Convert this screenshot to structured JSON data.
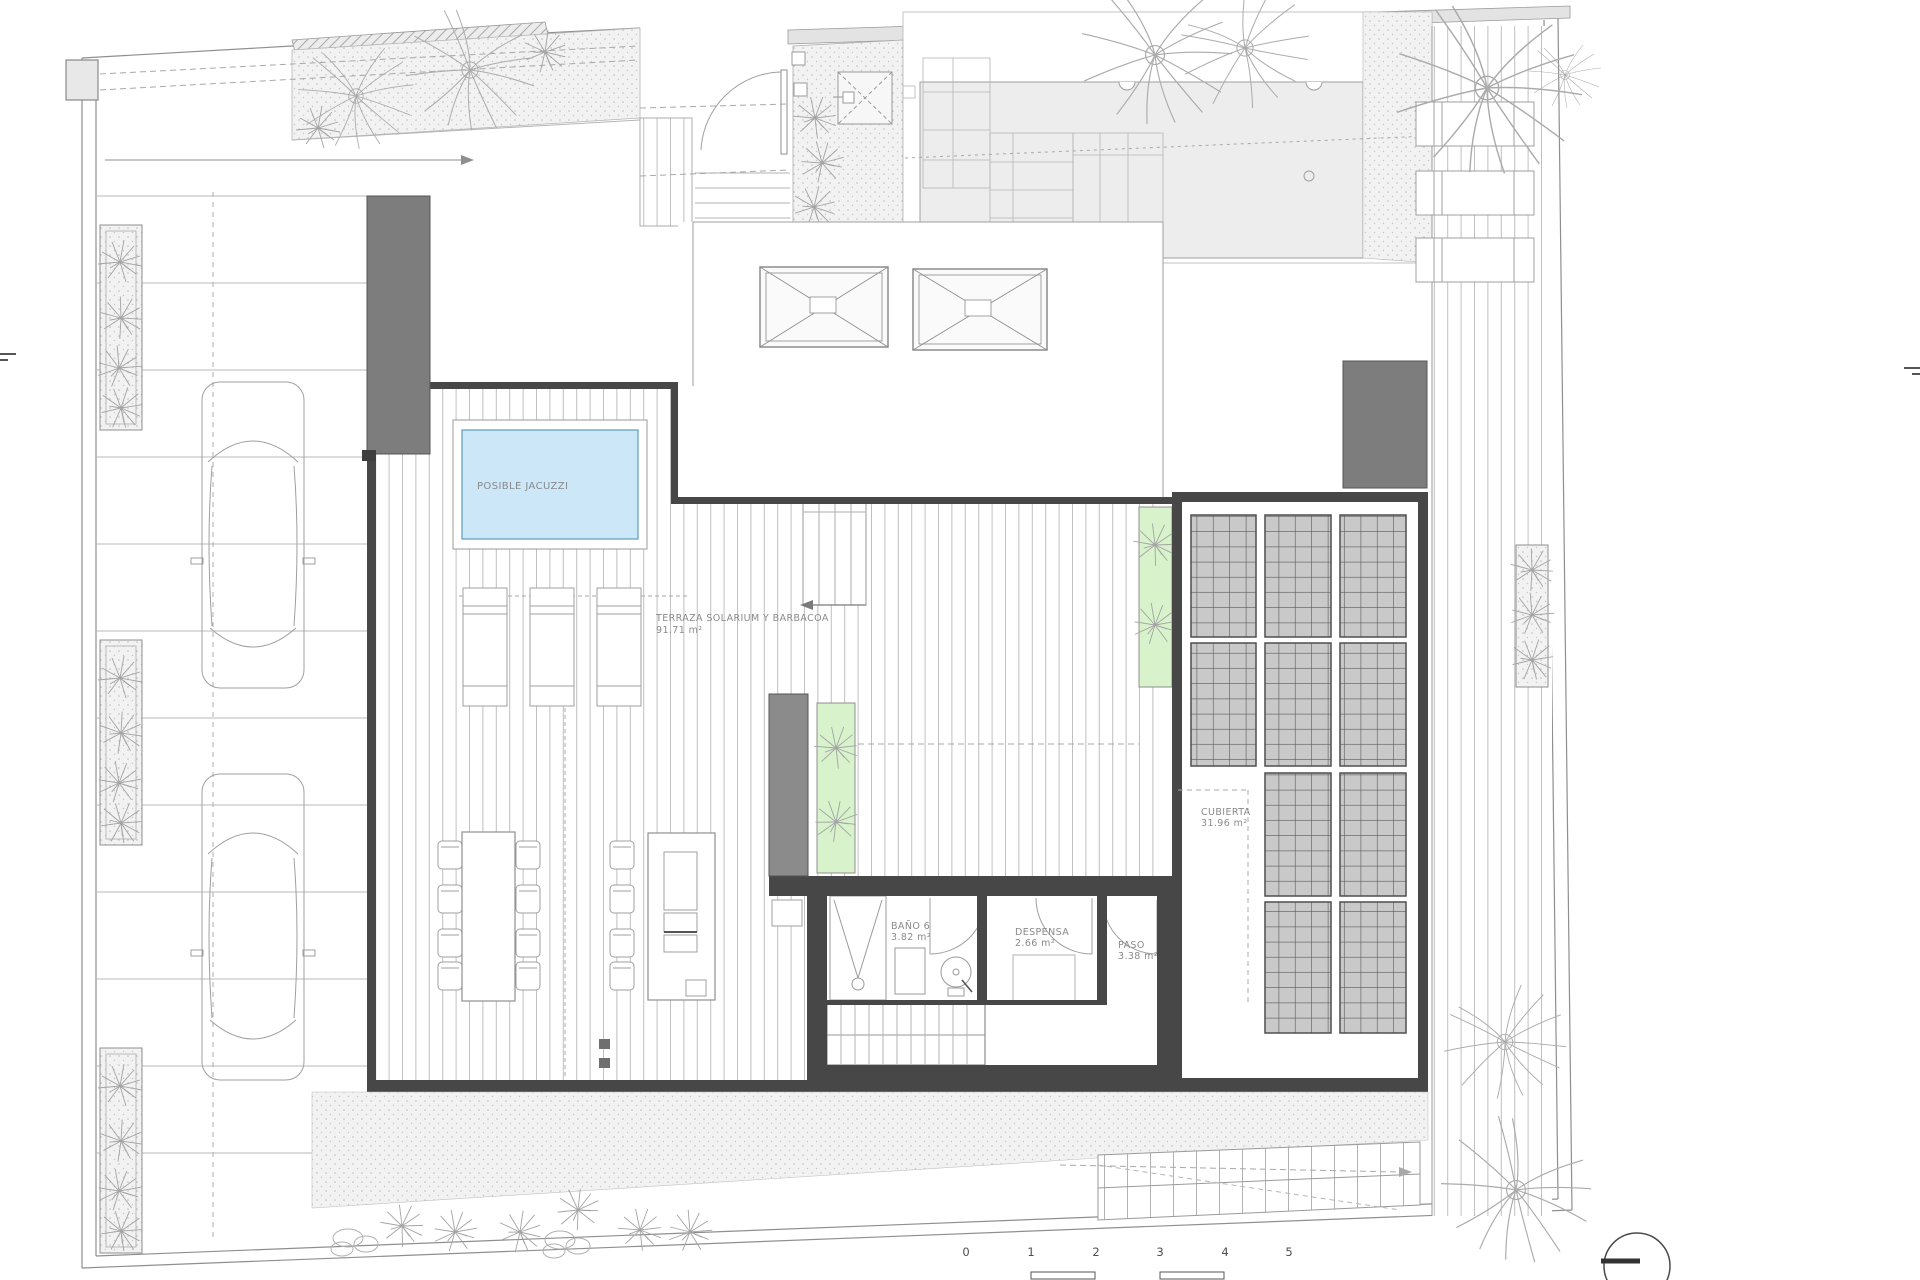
{
  "plan": {
    "labels": {
      "jacuzzi": "POSIBLE JACUZZI",
      "terraza": {
        "name": "TERRAZA SOLARIUM Y BARBACOA",
        "area": "91.71 m²"
      },
      "bano": {
        "name": "BAÑO 6",
        "area": "3.82 m²"
      },
      "despensa": {
        "name": "DESPENSA",
        "area": "2.66 m²"
      },
      "paso": {
        "name": "PASO",
        "area": "3.38 m²"
      },
      "cubierta": {
        "name": "CUBIERTA",
        "area": "31.96 m²"
      }
    },
    "scale_bar": {
      "ticks": [
        "0",
        "1",
        "2",
        "3",
        "4",
        "5"
      ]
    },
    "colors": {
      "jacuzzi_water": "#cbe7f8",
      "planter_green": "#d8f2cc",
      "wall_dark": "#474747",
      "block_grey": "#7d7d7d",
      "pergola_panel": "#c9c9c9",
      "pool_grey": "#ededed"
    }
  }
}
